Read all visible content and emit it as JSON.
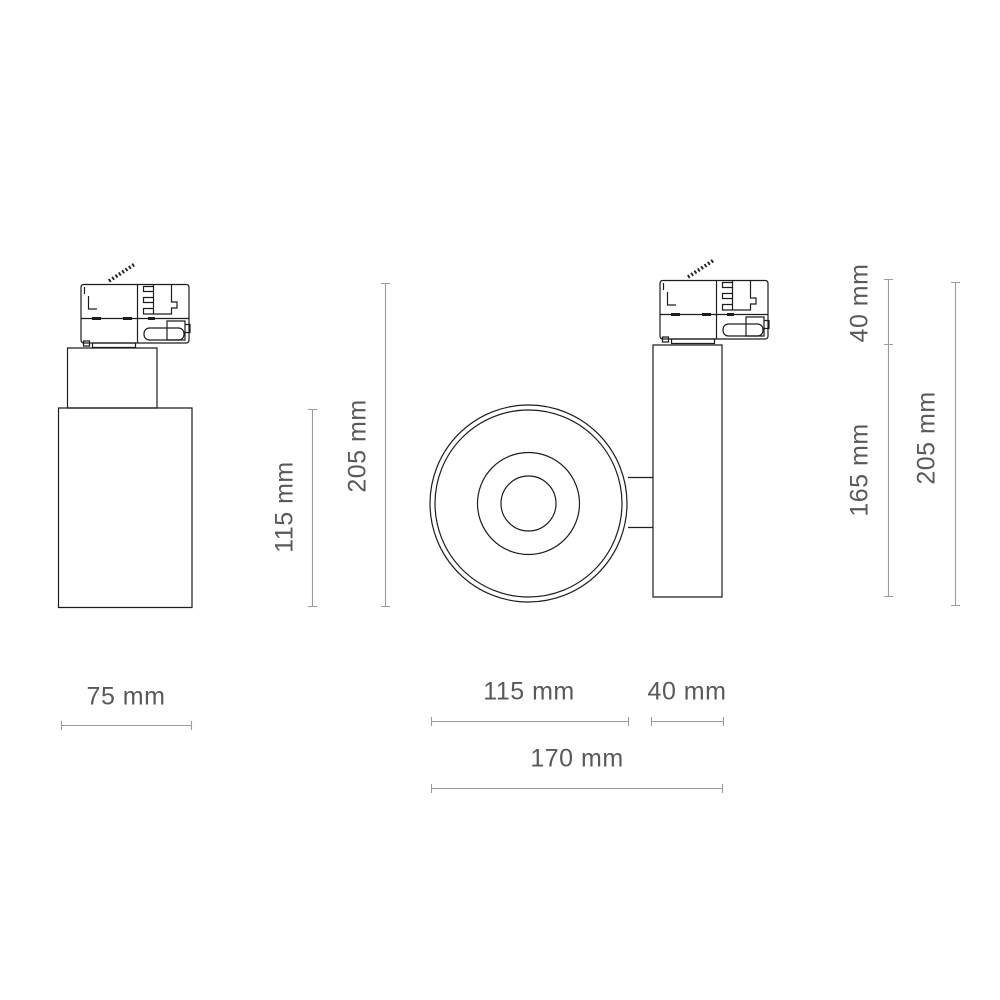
{
  "drawing_title": "Track spotlight dimension drawing",
  "colors": {
    "outline": "#1d1d1b",
    "dimension_line": "#9b9ca0",
    "label_text": "#58595b",
    "background": "#ffffff"
  },
  "views": {
    "front": {
      "body_height": "115 mm",
      "total_height": "205 mm",
      "width": "75 mm"
    },
    "top": {
      "lens_diameter": "115 mm",
      "body_depth": "40 mm",
      "total_depth": "170 mm"
    },
    "side": {
      "adapter_height": "40 mm",
      "body_height": "165 mm",
      "total_height": "205 mm"
    }
  }
}
